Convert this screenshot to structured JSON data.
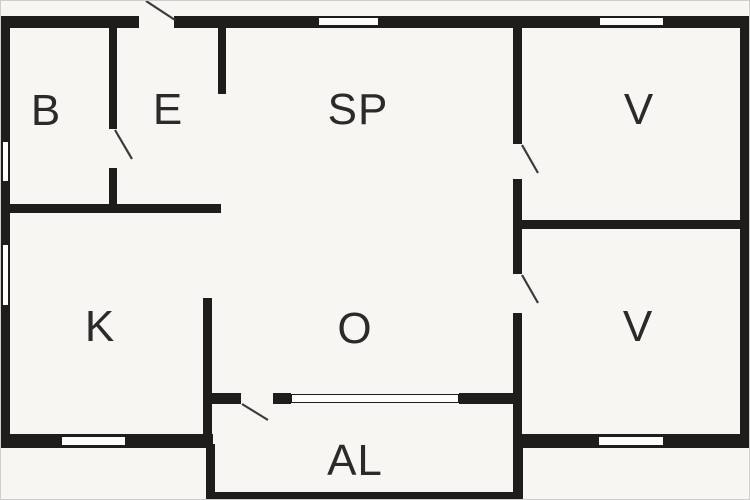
{
  "plan_title": "Floor plan",
  "canvas": {
    "width": 750,
    "height": 500,
    "background": "#f7f6f3",
    "frame_color": "#cfcecc"
  },
  "colors": {
    "wall": "#1f1d1b",
    "window_fill": "#fdfdfc",
    "window_frame": "#1f1d1b",
    "label": "#2b2a28",
    "door_swing": "#3c3a38"
  },
  "rooms": [
    {
      "name": "room-label-b",
      "label": "B",
      "cx": 45,
      "cy": 110
    },
    {
      "name": "room-label-e",
      "label": "E",
      "cx": 167,
      "cy": 109
    },
    {
      "name": "room-label-sp",
      "label": "SP",
      "cx": 357,
      "cy": 109
    },
    {
      "name": "room-label-v-top",
      "label": "V",
      "cx": 638,
      "cy": 109
    },
    {
      "name": "room-label-k",
      "label": "K",
      "cx": 99,
      "cy": 326
    },
    {
      "name": "room-label-o",
      "label": "O",
      "cx": 354,
      "cy": 328
    },
    {
      "name": "room-label-v-bottom",
      "label": "V",
      "cx": 637,
      "cy": 326
    },
    {
      "name": "room-label-al",
      "label": "AL",
      "cx": 354,
      "cy": 460
    }
  ],
  "walls": [
    {
      "name": "wall-exterior-top",
      "x": 0,
      "y": 15,
      "w": 750,
      "h": 12
    },
    {
      "name": "wall-exterior-left",
      "x": 0,
      "y": 15,
      "w": 9,
      "h": 432
    },
    {
      "name": "wall-exterior-right",
      "x": 739,
      "y": 15,
      "w": 11,
      "h": 432
    },
    {
      "name": "wall-exterior-bottom-left",
      "x": 0,
      "y": 433,
      "w": 212,
      "h": 14
    },
    {
      "name": "wall-exterior-bottom-right",
      "x": 512,
      "y": 433,
      "w": 238,
      "h": 14
    },
    {
      "name": "wall-b-e-upper",
      "x": 108,
      "y": 27,
      "w": 8,
      "h": 101
    },
    {
      "name": "wall-b-e-lower",
      "x": 108,
      "y": 167,
      "w": 8,
      "h": 38
    },
    {
      "name": "wall-be-k-divider",
      "x": 0,
      "y": 203,
      "w": 220,
      "h": 9
    },
    {
      "name": "wall-e-sp-stub",
      "x": 217,
      "y": 27,
      "w": 8,
      "h": 66
    },
    {
      "name": "wall-sp-v-upper",
      "x": 512,
      "y": 27,
      "w": 9,
      "h": 116
    },
    {
      "name": "wall-sp-v-mid",
      "x": 512,
      "y": 178,
      "w": 9,
      "h": 95
    },
    {
      "name": "wall-sp-v-lower",
      "x": 512,
      "y": 312,
      "w": 9,
      "h": 135
    },
    {
      "name": "wall-v-v-divider",
      "x": 512,
      "y": 219,
      "w": 238,
      "h": 9
    },
    {
      "name": "wall-k-o-divider",
      "x": 202,
      "y": 297,
      "w": 9,
      "h": 150
    },
    {
      "name": "wall-o-al-segment-1",
      "x": 202,
      "y": 392,
      "w": 38,
      "h": 11
    },
    {
      "name": "wall-o-al-segment-2",
      "x": 272,
      "y": 392,
      "w": 18,
      "h": 11
    },
    {
      "name": "wall-o-al-segment-3",
      "x": 458,
      "y": 392,
      "w": 63,
      "h": 11
    },
    {
      "name": "wall-al-left",
      "x": 205,
      "y": 443,
      "w": 9,
      "h": 57
    },
    {
      "name": "wall-al-right",
      "x": 512,
      "y": 443,
      "w": 10,
      "h": 57
    },
    {
      "name": "wall-al-bottom",
      "x": 205,
      "y": 491,
      "w": 317,
      "h": 9
    }
  ],
  "door_openings": [
    {
      "name": "door-opening-entry-top",
      "x": 138,
      "y": 14,
      "w": 35,
      "h": 14
    }
  ],
  "windows": [
    {
      "name": "window-top-sp",
      "x": 317,
      "y": 16,
      "w": 61,
      "h": 9
    },
    {
      "name": "window-top-v",
      "x": 598,
      "y": 16,
      "w": 65,
      "h": 9
    },
    {
      "name": "window-left-b",
      "x": 1,
      "y": 140,
      "w": 7,
      "h": 41
    },
    {
      "name": "window-left-k",
      "x": 1,
      "y": 243,
      "w": 7,
      "h": 62
    },
    {
      "name": "window-bottom-k",
      "x": 60,
      "y": 435,
      "w": 65,
      "h": 10
    },
    {
      "name": "window-bottom-v",
      "x": 597,
      "y": 435,
      "w": 66,
      "h": 10
    },
    {
      "name": "window-o-al",
      "x": 290,
      "y": 393,
      "w": 168,
      "h": 9
    }
  ],
  "door_swings": [
    {
      "name": "door-swing-entry-top",
      "x1": 145,
      "y1": 0,
      "x2": 174,
      "y2": 19
    },
    {
      "name": "door-swing-b-to-e",
      "x1": 114,
      "y1": 129,
      "x2": 131,
      "y2": 158
    },
    {
      "name": "door-swing-sp-to-v",
      "x1": 521,
      "y1": 144,
      "x2": 537,
      "y2": 172
    },
    {
      "name": "door-swing-o-to-v",
      "x1": 521,
      "y1": 274,
      "x2": 537,
      "y2": 302
    },
    {
      "name": "door-swing-o-to-al",
      "x1": 241,
      "y1": 403,
      "x2": 267,
      "y2": 419
    }
  ]
}
